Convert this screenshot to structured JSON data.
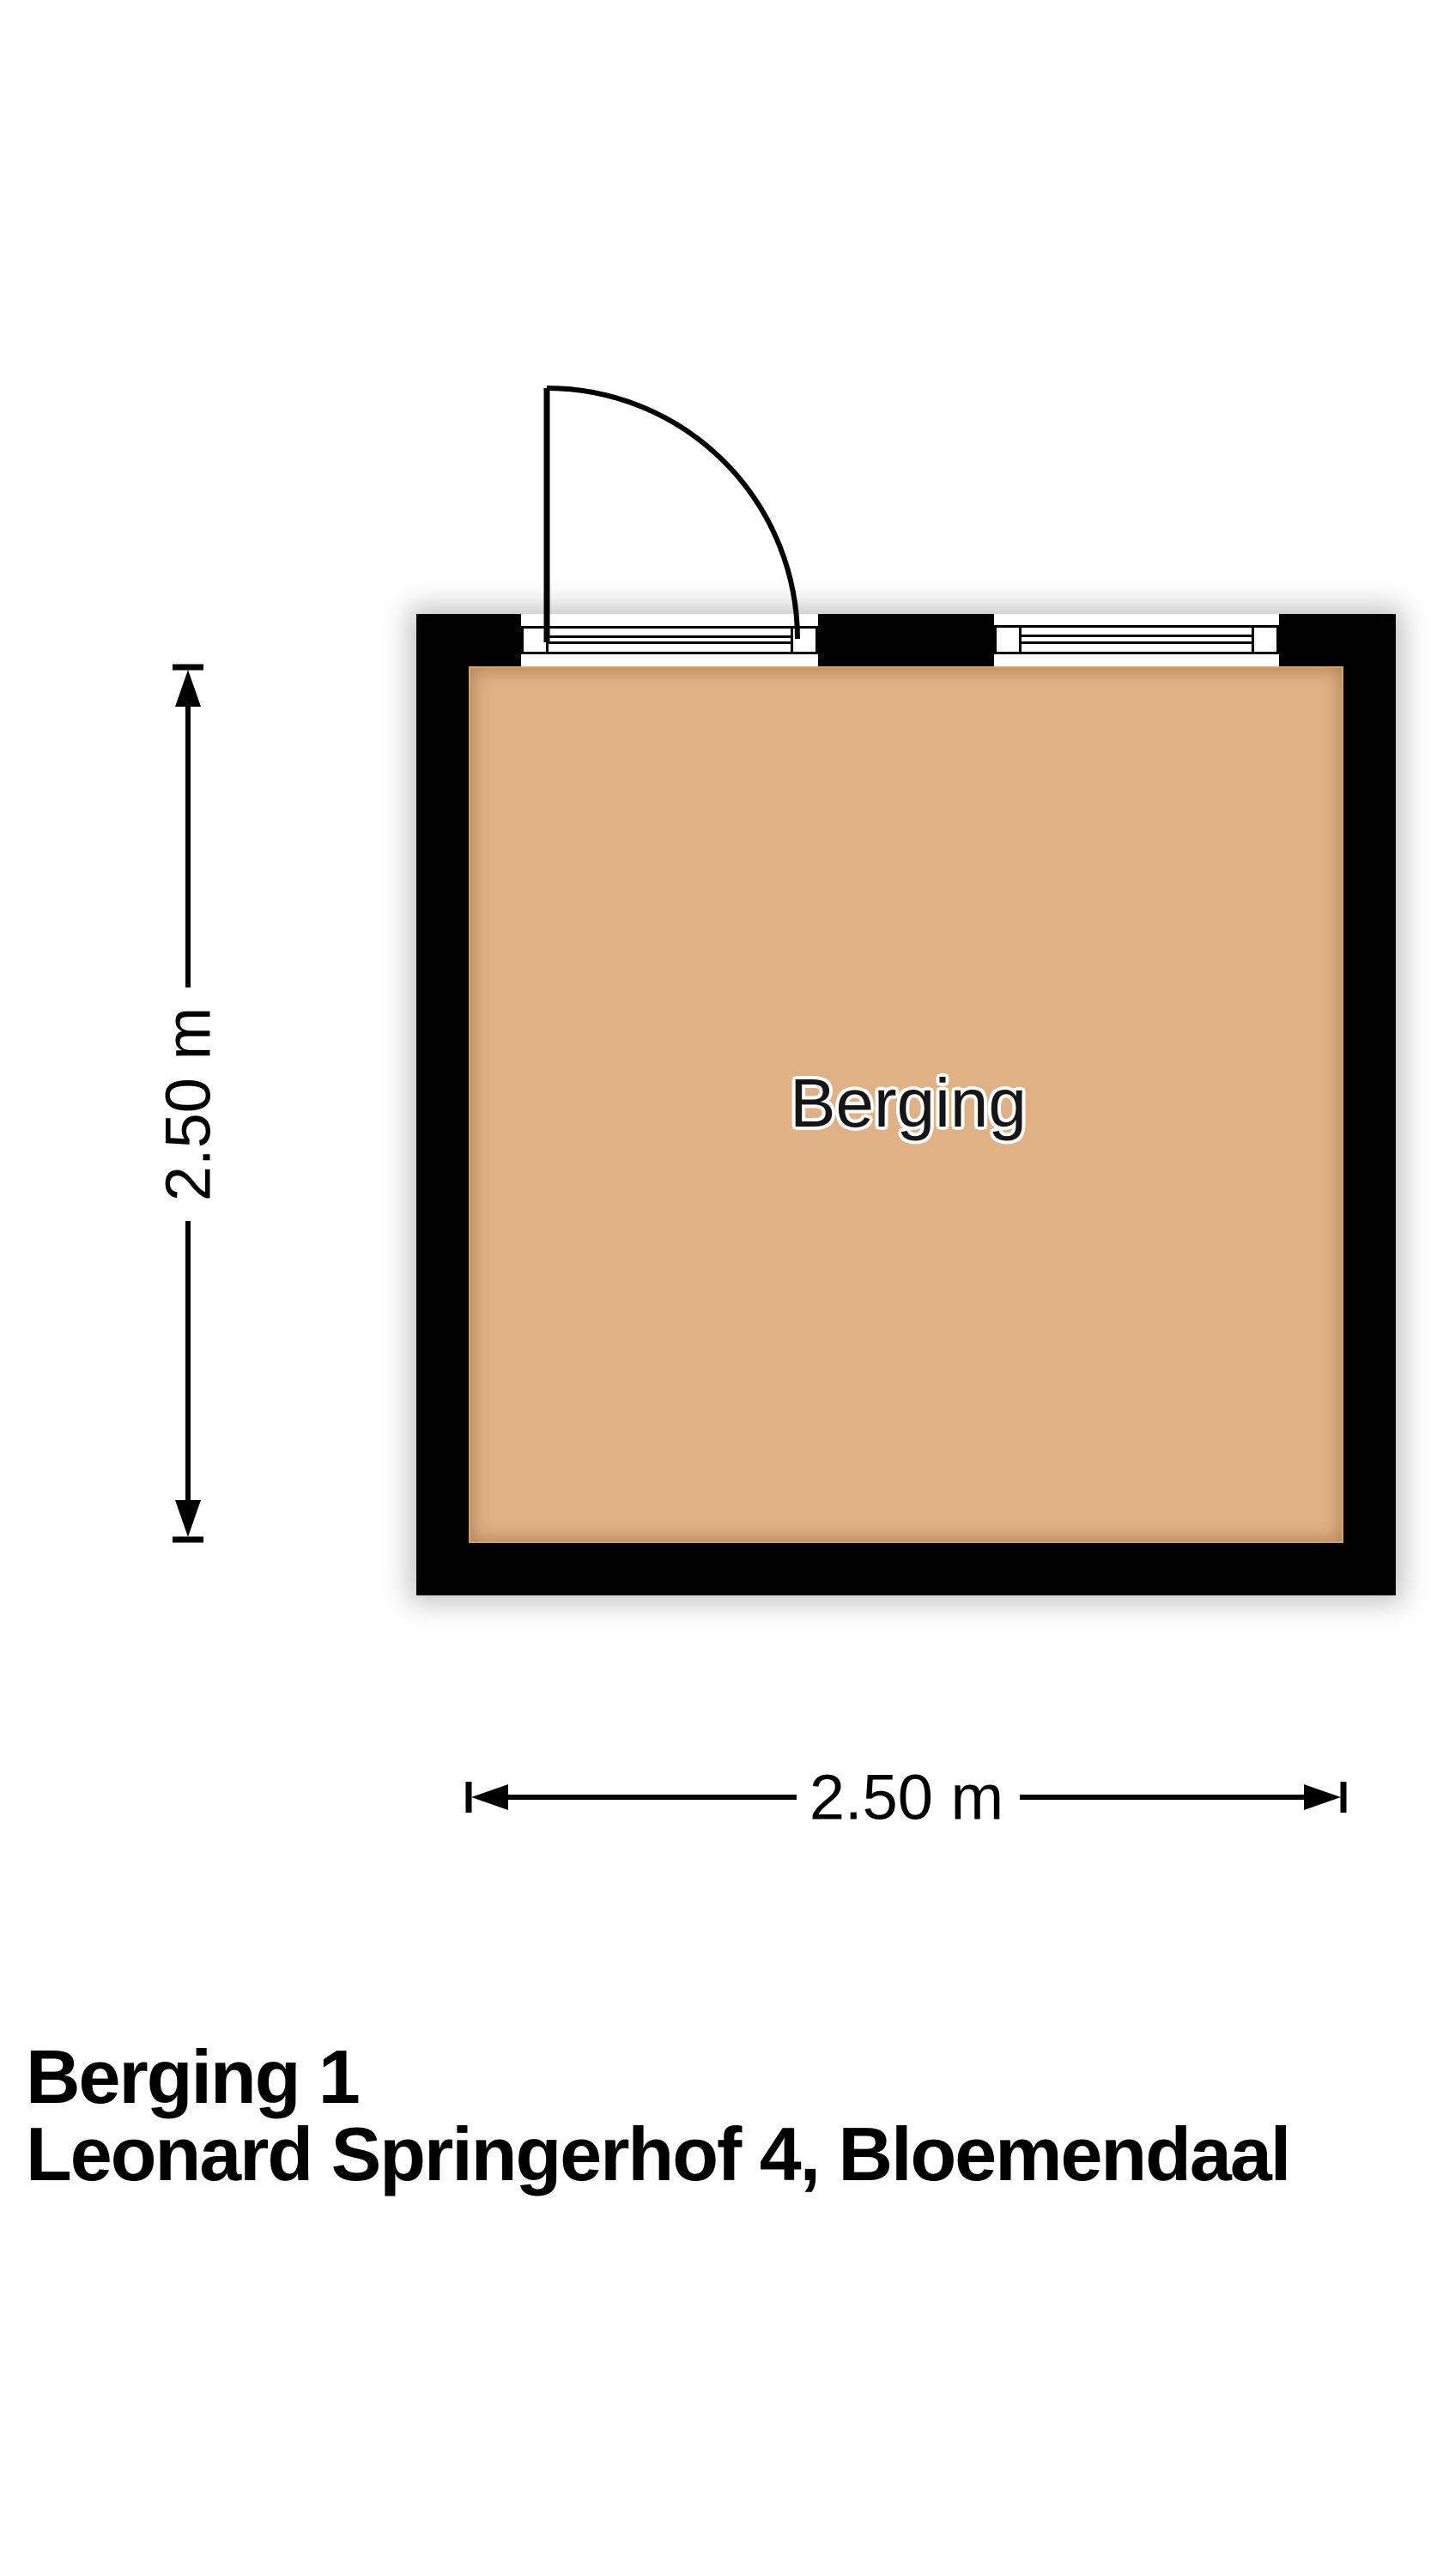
{
  "plan": {
    "room_label": "Berging",
    "wall_color": "#000000",
    "floor_color": "#dfb184",
    "background_color": "#ffffff"
  },
  "dimensions": {
    "vertical_label": "2.50 m",
    "horizontal_label": "2.50 m"
  },
  "footer": {
    "line1": "Berging 1",
    "line2": "Leonard Springerhof 4, Bloemendaal"
  }
}
